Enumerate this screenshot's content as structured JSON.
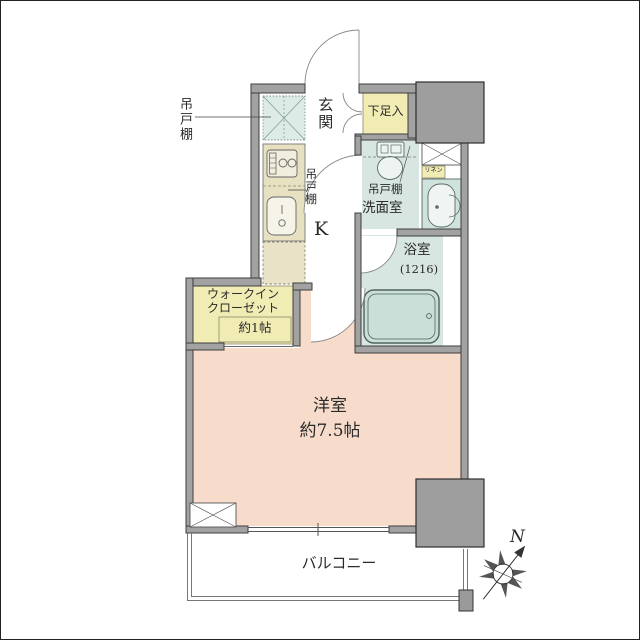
{
  "floorplan": {
    "labels": {
      "hanging_cabinet_left": "吊戸棚",
      "entrance": "玄関",
      "shoe_cabinet": "下足入",
      "hanging_cabinet_kitchen": "吊戸棚",
      "kitchen": "K",
      "hanging_cabinet_washroom": "吊戸棚",
      "washroom": "洗面室",
      "linen": "リネン",
      "bathroom": "浴室",
      "bathroom_size": "(1216)",
      "walk_in_closet_line1": "ウォークイン",
      "walk_in_closet_line2": "クローゼット",
      "walk_in_closet_size": "約1帖",
      "western_room": "洋室",
      "western_room_size": "約7.5帖",
      "balcony": "バルコニー",
      "compass_north": "N"
    },
    "colors": {
      "room_pink": "#f7dccb",
      "wet_area_blue": "#d7e6e0",
      "cabinet_yellow": "#f1ecb4",
      "counter_beige": "#e8e1c1",
      "bathtub_blue": "#cadfd8",
      "wall_gray": "#a2a2a2"
    }
  }
}
